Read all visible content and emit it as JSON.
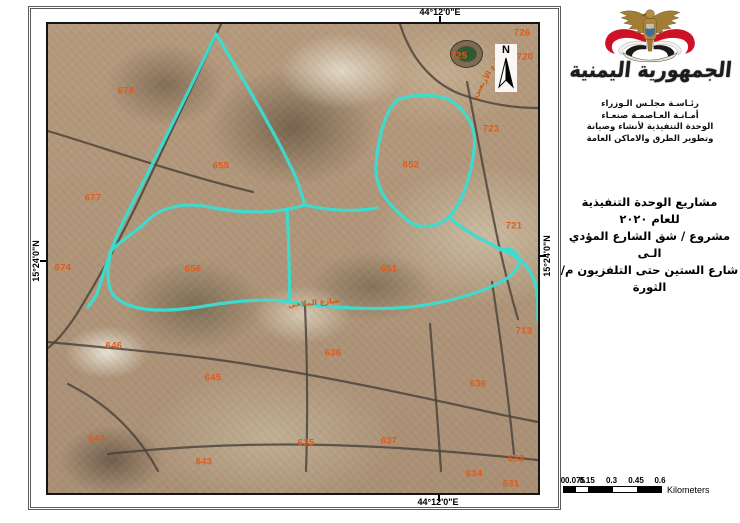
{
  "colors": {
    "route": "#38ded2",
    "zone": "#e05a1a",
    "street": "#d4590f",
    "road": "#474038"
  },
  "map": {
    "coordinates": {
      "top": "44°12'0\"E",
      "bottom": "44°12'0\"E",
      "left": "15°24'0\"N",
      "right": "15°24'0\"N"
    },
    "north_label": "N",
    "zones": [
      {
        "label": "678",
        "x": 78,
        "y": 67
      },
      {
        "label": "655",
        "x": 173,
        "y": 142
      },
      {
        "label": "677",
        "x": 45,
        "y": 174
      },
      {
        "label": "674",
        "x": 15,
        "y": 244
      },
      {
        "label": "656",
        "x": 145,
        "y": 245
      },
      {
        "label": "651",
        "x": 341,
        "y": 245
      },
      {
        "label": "725",
        "x": 411,
        "y": 32
      },
      {
        "label": "726",
        "x": 474,
        "y": 9
      },
      {
        "label": "720",
        "x": 477,
        "y": 33
      },
      {
        "label": "723",
        "x": 443,
        "y": 105
      },
      {
        "label": "652",
        "x": 363,
        "y": 141
      },
      {
        "label": "721",
        "x": 466,
        "y": 202
      },
      {
        "label": "713",
        "x": 476,
        "y": 307
      },
      {
        "label": "646",
        "x": 66,
        "y": 322
      },
      {
        "label": "645",
        "x": 165,
        "y": 354
      },
      {
        "label": "644",
        "x": 49,
        "y": 415
      },
      {
        "label": "643",
        "x": 156,
        "y": 438
      },
      {
        "label": "638",
        "x": 285,
        "y": 329
      },
      {
        "label": "636",
        "x": 430,
        "y": 360
      },
      {
        "label": "635",
        "x": 258,
        "y": 419
      },
      {
        "label": "637",
        "x": 341,
        "y": 417
      },
      {
        "label": "633",
        "x": 468,
        "y": 435
      },
      {
        "label": "634",
        "x": 426,
        "y": 450
      },
      {
        "label": "631",
        "x": 463,
        "y": 460
      }
    ],
    "streets": [
      {
        "label": "شارع الأربعين",
        "x": 414,
        "y": 46,
        "rot": -58
      },
      {
        "label": "شارع الملاحي",
        "x": 240,
        "y": 274,
        "rot": -5
      }
    ]
  },
  "panel": {
    "calligraphy": "الجمهورية اليمنية",
    "org_lines": [
      "رئـاسـة مجلـس الـوزراء",
      "أمـانـة العـاصمـة صنعـاء",
      "الوحدة التنفيذية لأنشاء وصيانة",
      "وتطوير الطرق والاماكن العامة"
    ],
    "title_lines": [
      "مشاريع الوحدة التنفيذية",
      "للعام ٢٠٢٠",
      "مشروع / شق الشارع المؤدي الـى",
      "شارع الستين حتى التلفزيون م/الثورة"
    ],
    "scalebar": {
      "labels": [
        "0",
        "0.075",
        "0.15",
        "0.3",
        "0.45",
        "0.6"
      ],
      "unit": "Kilometers"
    }
  }
}
